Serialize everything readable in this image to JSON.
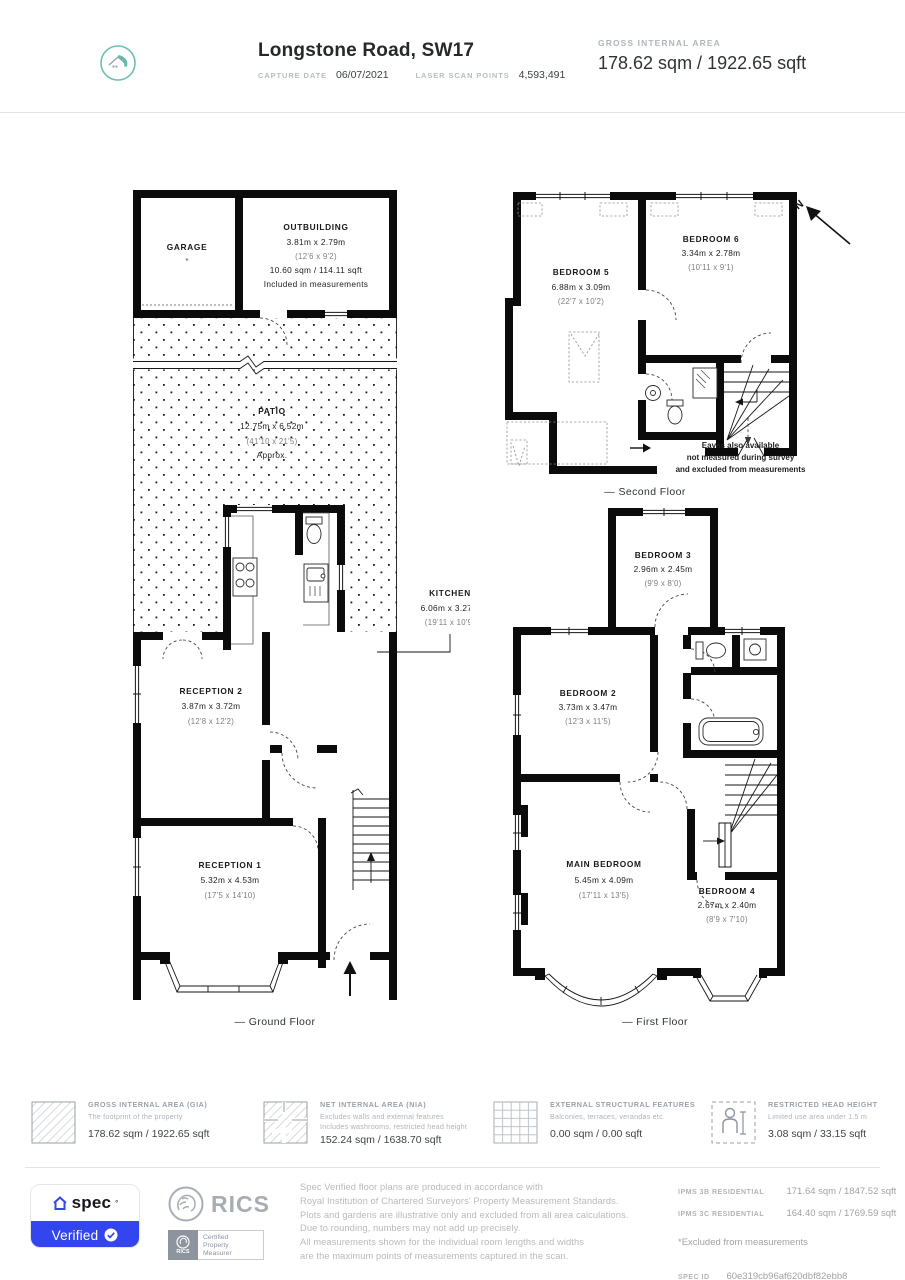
{
  "header": {
    "title": "Longstone Road, SW17",
    "capture_date_label": "CAPTURE DATE",
    "capture_date_value": "06/07/2021",
    "laser_scan_label": "LASER SCAN POINTS",
    "laser_scan_value": "4,593,491",
    "gia_label": "GROSS INTERNAL AREA",
    "gia_value": "178.62 sqm / 1922.65 sqft"
  },
  "plans": {
    "north_label": "N",
    "ground": {
      "floor_label": "— Ground Floor",
      "garage": {
        "name": "GARAGE",
        "footnote": "*"
      },
      "outbuilding": {
        "name": "OUTBUILDING",
        "dims_m": "3.81m x 2.79m",
        "dims_ft": "(12'6 x 9'2)",
        "area": "10.60 sqm / 114.11 sqft",
        "note": "Included in measurements"
      },
      "patio": {
        "name": "PATIO",
        "dims_m": "12.75m x 6.52m",
        "dims_ft": "(41'10 x 21'5)",
        "note": "Approx."
      },
      "kitchen": {
        "name": "KITCHEN",
        "dims_m": "6.06m x 3.27m",
        "dims_ft": "(19'11 x 10'9)"
      },
      "reception2": {
        "name": "RECEPTION 2",
        "dims_m": "3.87m x 3.72m",
        "dims_ft": "(12'8 x 12'2)"
      },
      "reception1": {
        "name": "RECEPTION 1",
        "dims_m": "5.32m x 4.53m",
        "dims_ft": "(17'5 x 14'10)"
      }
    },
    "second": {
      "floor_label": "— Second Floor",
      "bedroom5": {
        "name": "BEDROOM 5",
        "dims_m": "6.88m x 3.09m",
        "dims_ft": "(22'7 x 10'2)"
      },
      "bedroom6": {
        "name": "BEDROOM 6",
        "dims_m": "3.34m x 2.78m",
        "dims_ft": "(10'11 x 9'1)"
      },
      "eaves_line1": "Eaves also available",
      "eaves_line2": "not measured during survey",
      "eaves_line3": "and excluded from measurements"
    },
    "first": {
      "floor_label": "— First Floor",
      "bedroom3": {
        "name": "BEDROOM 3",
        "dims_m": "2.96m x 2.45m",
        "dims_ft": "(9'9 x 8'0)"
      },
      "bedroom2": {
        "name": "BEDROOM 2",
        "dims_m": "3.73m x 3.47m",
        "dims_ft": "(12'3 x 11'5)"
      },
      "main_bedroom": {
        "name": "MAIN BEDROOM",
        "dims_m": "5.45m x 4.09m",
        "dims_ft": "(17'11 x 13'5)"
      },
      "bedroom4": {
        "name": "BEDROOM 4",
        "dims_m": "2.67m x 2.40m",
        "dims_ft": "(8'9 x 7'10)"
      }
    }
  },
  "legend": {
    "gia": {
      "title": "GROSS INTERNAL AREA (GIA)",
      "desc1": "The footprint of the property",
      "value": "178.62 sqm / 1922.65 sqft"
    },
    "nia": {
      "title": "NET INTERNAL AREA (NIA)",
      "desc1": "Excludes walls and external features",
      "desc2": "Includes washrooms, restricted head height",
      "value": "152.24 sqm / 1638.70 sqft"
    },
    "esf": {
      "title": "EXTERNAL STRUCTURAL FEATURES",
      "desc1": "Balconies, terraces, verandas etc.",
      "value": "0.00 sqm / 0.00 sqft"
    },
    "rhh": {
      "title": "RESTRICTED HEAD HEIGHT",
      "desc1": "Limited use area under 1.5 m",
      "value": "3.08 sqm / 33.15 sqft"
    }
  },
  "footer": {
    "accent_blue": "#3345ee",
    "brand_teal": "#5fbcab",
    "spec_brand": "spec",
    "verified_label": "Verified",
    "rics_name": "RICS",
    "cert_line1": "Certified",
    "cert_line2": "Property",
    "cert_line3": "Measurer",
    "disclaimer": [
      "Spec Verified floor plans are produced in accordance with",
      "Royal Institution of Chartered Surveyors' Property Measurement Standards.",
      "Plots and gardens are illustrative only and excluded from all area calculations.",
      "Due to rounding, numbers may not add up precisely.",
      "All measurements shown for the individual room lengths and widths",
      "are the maximum points of measurements captured in the scan."
    ],
    "ipms3b_label": "IPMS 3B RESIDENTIAL",
    "ipms3b_value": "171.64 sqm / 1847.52 sqft",
    "ipms3c_label": "IPMS 3C RESIDENTIAL",
    "ipms3c_value": "164.40 sqm / 1769.59 sqft",
    "excluded_note": "*Excluded from measurements",
    "spec_id_label": "SPEC ID",
    "spec_id_value": "60e319cb96af620dbf82ebb8"
  }
}
